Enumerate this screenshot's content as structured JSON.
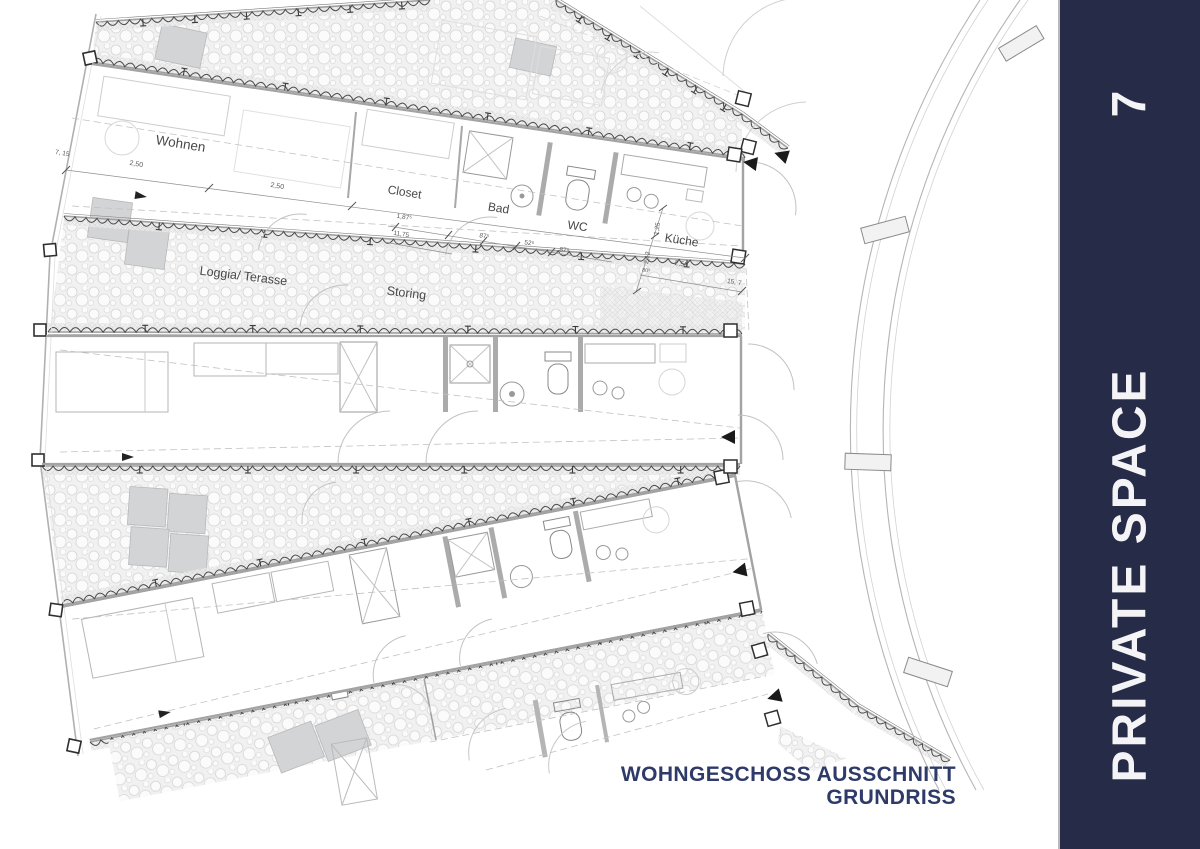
{
  "page": {
    "background": "#ffffff"
  },
  "sidebar": {
    "background": "#262b48",
    "text_color": "#f4f4f6",
    "number": "7",
    "title": "PRIVATE SPACE"
  },
  "title_block": {
    "color": "#2e3a68",
    "line1": "WOHNGESCHOSS AUSSCHNITT",
    "line2": "GRUNDRISS"
  },
  "plan": {
    "drawing_type": "floor plan excerpt of circular residential building",
    "room_labels": {
      "wohnen": "Wohnen",
      "closet": "Closet",
      "bad": "Bad",
      "wc": "WC",
      "kueche": "Küche",
      "loggia_terasse": "Loggia/ Terasse",
      "storing": "Storing"
    },
    "dimensions": [
      "7, 15",
      "2,50",
      "2,50",
      "1,87⁵",
      "11,75",
      "87⁵",
      "52⁵",
      "87⁵",
      "1,25",
      "2,12",
      "80⁵",
      "2,50",
      "15, 7"
    ]
  },
  "colors": {
    "accent_navy": "#262b48",
    "title_navy": "#2e3a68",
    "plan_line": "#9d9d9d",
    "hatch_bg": "#f1f1f1"
  }
}
